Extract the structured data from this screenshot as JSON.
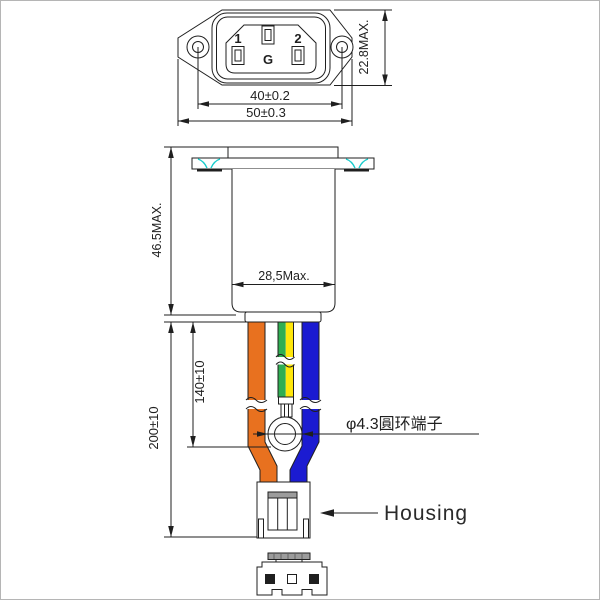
{
  "front_view": {
    "pin1": "1",
    "pin2": "2",
    "ground": "G",
    "dim_hole_spacing": "40±0.2",
    "dim_overall_width": "50±0.3",
    "dim_height": "22.8MAX."
  },
  "side_view": {
    "dim_body_height": "46.5MAX.",
    "dim_body_width": "28,5Max."
  },
  "cable": {
    "dim_to_terminal": "140±10",
    "dim_overall_length": "200±10",
    "ring_terminal_label": "φ4.3圓环端子"
  },
  "housing": {
    "label": "Housing"
  },
  "colors": {
    "line": "#1f1f1f",
    "wire_orange": "#e8711f",
    "wire_green": "#2fae52",
    "wire_yellow": "#ffe70a",
    "wire_blue": "#1b1bd1",
    "flange_accent": "#19cccc",
    "housing_gray": "#9c9c9c"
  }
}
